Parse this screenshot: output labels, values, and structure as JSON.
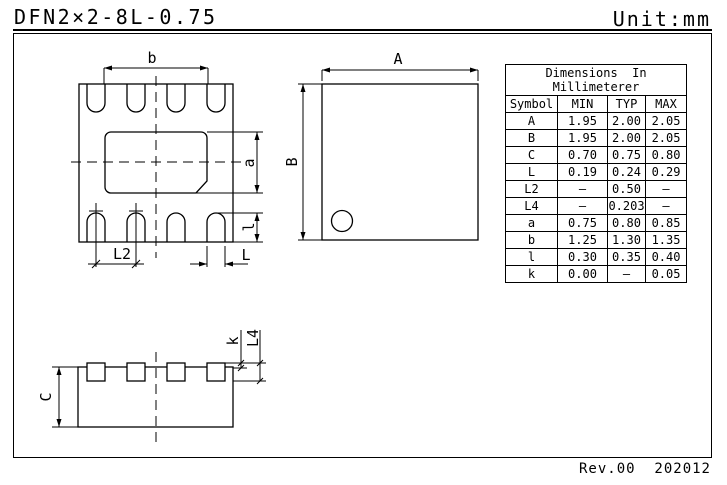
{
  "page": {
    "title": "DFN2×2-8L-0.75",
    "unit_label": "Unit:mm",
    "revision": "Rev.00  202012"
  },
  "table": {
    "title_line1": "Dimensions  In",
    "title_line2": "Millimeterer",
    "columns": [
      "Symbol",
      "MIN",
      "TYP",
      "MAX"
    ],
    "rows": [
      {
        "symbol": "A",
        "min": "1.95",
        "typ": "2.00",
        "max": "2.05"
      },
      {
        "symbol": "B",
        "min": "1.95",
        "typ": "2.00",
        "max": "2.05"
      },
      {
        "symbol": "C",
        "min": "0.70",
        "typ": "0.75",
        "max": "0.80"
      },
      {
        "symbol": "L",
        "min": "0.19",
        "typ": "0.24",
        "max": "0.29"
      },
      {
        "symbol": "L2",
        "min": "–",
        "typ": "0.50",
        "max": "–"
      },
      {
        "symbol": "L4",
        "min": "–",
        "typ": "0.203",
        "max": "–"
      },
      {
        "symbol": "a",
        "min": "0.75",
        "typ": "0.80",
        "max": "0.85"
      },
      {
        "symbol": "b",
        "min": "1.25",
        "typ": "1.30",
        "max": "1.35"
      },
      {
        "symbol": "l",
        "min": "0.30",
        "typ": "0.35",
        "max": "0.40"
      },
      {
        "symbol": "k",
        "min": "0.00",
        "typ": "–",
        "max": "0.05"
      }
    ]
  },
  "dimension_labels": {
    "b": "b",
    "a": "a",
    "l": "l",
    "L2": "L2",
    "L": "L",
    "A": "A",
    "B": "B",
    "C": "C",
    "k": "k",
    "L4": "L4"
  },
  "colors": {
    "line": "#000000",
    "background": "#ffffff"
  }
}
